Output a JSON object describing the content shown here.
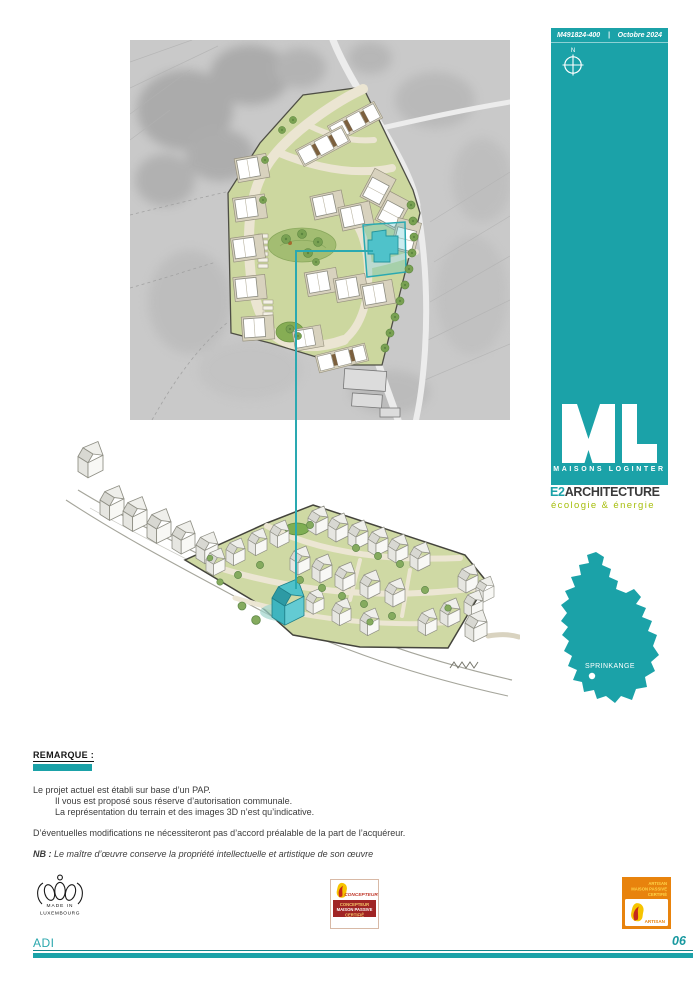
{
  "sidebar": {
    "doc_number": "M491824-400",
    "separator": "|",
    "date": "Octobre 2024",
    "compass_label": "N",
    "logo_letters": "ML",
    "logo_caption": "MAISONS LOGINTER"
  },
  "brand": {
    "e2_prefix": "E2",
    "e2_rest": "ARCHITECTURE",
    "tagline": "écologie & énergie"
  },
  "map": {
    "location_label": "SPRINKANGE"
  },
  "remarque": {
    "title": "REMARQUE :",
    "line1": "Le projet actuel est établi sur base d’un PAP.",
    "line2": "Il vous est proposé sous réserve d’autorisation communale.",
    "line3": "La représentation du terrain et des images 3D n’est qu’indicative.",
    "para2": "D’éventuelles modifications ne nécessiteront pas d’accord préalable de la part de l’acquéreur.",
    "nb_label": "NB :",
    "nb_text": "Le maître d’œuvre conserve la propriété intellectuelle et artistique de son œuvre"
  },
  "badges": {
    "made_in": {
      "line1": "MADE IN",
      "line2": "LUXEMBOURG"
    },
    "concepteur": {
      "brand": "CONCEPTEUR",
      "box_line1": "CONCEPTEUR",
      "box_line2": "MAISON PASSIVE",
      "box_line3": "CERTIFIÉ"
    },
    "artisan": {
      "top_line1": "ARTISAN",
      "top_line2": "MAISON PASSIVE",
      "top_line3": "CERTIFIÉ",
      "label": "ARTISAN"
    }
  },
  "footer": {
    "project_code": "ADI",
    "page_number": "06"
  },
  "colors": {
    "teal": "#1BA2A8",
    "eco_green": "#A6BE0B",
    "highlight_teal": "#4FC2CA",
    "badge_red": "#A02424",
    "badge_orange": "#E8830D"
  }
}
